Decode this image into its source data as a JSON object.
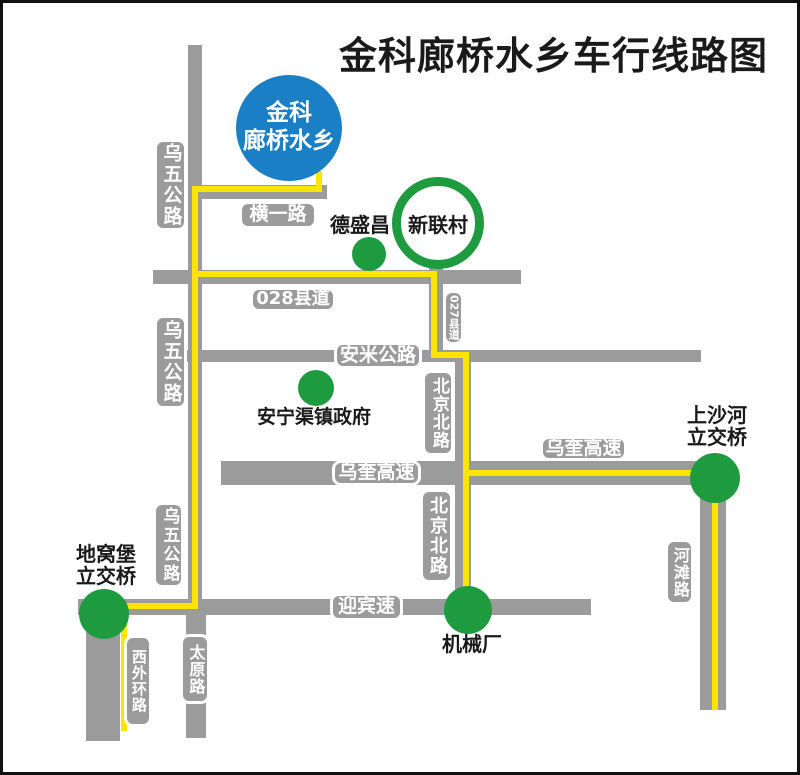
{
  "title": "金科廊桥水乡车行线路图",
  "landmark": {
    "line1": "金科",
    "line2": "廊桥水乡"
  },
  "roads": {
    "wuwu": "乌五公路",
    "hengyi": "横一路",
    "x028": "028县道",
    "x027": "027县道",
    "anmi": "安米公路",
    "beijing_north": "北京北路",
    "wukui": "乌奎高速",
    "yingbin": "迎宾速",
    "hetan": "河滩路",
    "taiyuan": "太原路",
    "xiwaihuan": "西外环路"
  },
  "places": {
    "xinlian": "新联村",
    "desheng": "德盛昌",
    "anningqu": "安宁渠镇政府",
    "jixie": "机械厂",
    "shangshahe_line1": "上沙河",
    "shangshahe_line2": "立交桥",
    "diwopu_line1": "地窝堡",
    "diwopu_line2": "立交桥"
  },
  "colors": {
    "route_yellow": "#ffe400",
    "road_gray": "#9b9b9b",
    "landmark_blue": "#1a7fc4",
    "poi_green": "#1f9b3f",
    "text_black": "#1a1a1a"
  }
}
